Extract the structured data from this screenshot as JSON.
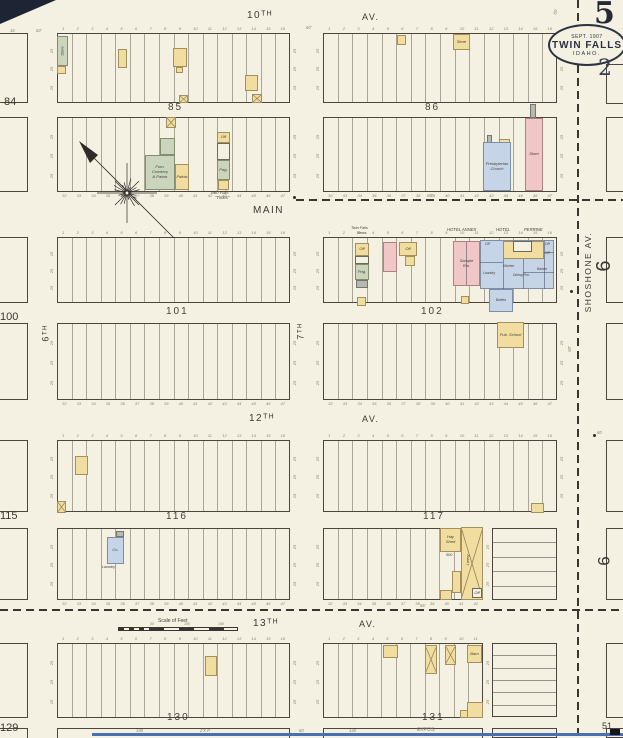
{
  "sheet": {
    "big_number": "5",
    "small_number": "2",
    "badge_date": "SEPT. 1907",
    "badge_city": "TWIN FALLS",
    "badge_state": "IDAHO."
  },
  "palette": {
    "paper": "#f4f0e2",
    "ink": "#4c463e",
    "cy": "#f1dd9f",
    "cp": "#f0c6c6",
    "cb": "#c5d4e7",
    "cg": "#cbd4bd",
    "cgr": "#b7b9b0",
    "scan": "#4a6fb3"
  },
  "lots": {
    "above_start": 1,
    "below_start": 32,
    "side_tick": "25"
  },
  "geometry": {
    "blocks": [
      [
        57,
        33,
        233,
        70,
        16,
        "a"
      ],
      [
        323,
        33,
        234,
        70,
        16,
        "a"
      ],
      [
        57,
        117,
        233,
        75,
        16,
        "b"
      ],
      [
        323,
        117,
        234,
        75,
        16,
        "b"
      ],
      [
        57,
        237,
        233,
        66,
        16,
        "a"
      ],
      [
        323,
        237,
        234,
        66,
        16,
        "a"
      ],
      [
        57,
        323,
        233,
        77,
        16,
        "b"
      ],
      [
        323,
        323,
        234,
        77,
        16,
        "b"
      ],
      [
        57,
        440,
        233,
        72,
        16,
        "a"
      ],
      [
        323,
        440,
        234,
        72,
        16,
        "a"
      ],
      [
        57,
        528,
        233,
        72,
        16,
        "b"
      ],
      [
        323,
        528,
        160,
        72,
        11,
        "b"
      ],
      [
        57,
        643,
        233,
        75,
        16,
        "a"
      ],
      [
        323,
        643,
        160,
        75,
        11,
        "a"
      ],
      [
        57,
        728,
        233,
        12,
        0,
        ""
      ],
      [
        323,
        728,
        160,
        12,
        0,
        ""
      ],
      [
        492,
        728,
        65,
        10,
        0,
        ""
      ]
    ],
    "partials": [
      [
        -14,
        33,
        42,
        70
      ],
      [
        -14,
        117,
        42,
        75
      ],
      [
        -14,
        237,
        42,
        66
      ],
      [
        -14,
        323,
        42,
        77
      ],
      [
        -14,
        440,
        42,
        72
      ],
      [
        -14,
        528,
        42,
        72
      ],
      [
        -14,
        643,
        42,
        75
      ],
      [
        -14,
        728,
        42,
        12
      ],
      [
        606,
        64,
        26,
        40
      ],
      [
        606,
        117,
        26,
        75
      ],
      [
        606,
        237,
        26,
        66
      ],
      [
        606,
        323,
        26,
        77
      ],
      [
        606,
        440,
        26,
        72
      ],
      [
        606,
        528,
        26,
        72
      ],
      [
        606,
        643,
        26,
        75
      ],
      [
        606,
        728,
        26,
        10
      ]
    ],
    "sections": [
      [
        492,
        528,
        65,
        72,
        5
      ],
      [
        492,
        643,
        65,
        74,
        6
      ]
    ],
    "dashes": [
      [
        "h",
        296,
        199,
        327
      ],
      [
        "h",
        0,
        609,
        623
      ],
      [
        "v",
        577,
        0,
        738
      ]
    ],
    "dots": [
      [
        294,
        197
      ],
      [
        571,
        291
      ],
      [
        594,
        435
      ]
    ],
    "ilines": [
      [
        503,
        259,
        503,
        289
      ],
      [
        523,
        259,
        523,
        289
      ],
      [
        544,
        241,
        544,
        289
      ],
      [
        480,
        262,
        503,
        262
      ],
      [
        523,
        272,
        554,
        272
      ],
      [
        544,
        252,
        554,
        252
      ],
      [
        466,
        242,
        466,
        285
      ]
    ]
  },
  "buildings": [
    {
      "x": 57,
      "y": 36,
      "w": 11,
      "h": 30,
      "c": "g",
      "l": "Store",
      "lr": -90
    },
    {
      "x": 57,
      "y": 66,
      "w": 9,
      "h": 8,
      "c": "y"
    },
    {
      "x": 118,
      "y": 49,
      "w": 9,
      "h": 19,
      "c": "y"
    },
    {
      "x": 173,
      "y": 48,
      "w": 14,
      "h": 19,
      "c": "y"
    },
    {
      "x": 176,
      "y": 67,
      "w": 7,
      "h": 6,
      "c": "y"
    },
    {
      "x": 245,
      "y": 75,
      "w": 13,
      "h": 16,
      "c": "y"
    },
    {
      "x": 179,
      "y": 95,
      "w": 9,
      "h": 8,
      "c": "y",
      "xm": 1
    },
    {
      "x": 252,
      "y": 94,
      "w": 10,
      "h": 9,
      "c": "y",
      "xm": 1
    },
    {
      "x": 166,
      "y": 117,
      "w": 10,
      "h": 11,
      "c": "y",
      "xm": 1
    },
    {
      "x": 160,
      "y": 138,
      "w": 15,
      "h": 17,
      "c": "g"
    },
    {
      "x": 145,
      "y": 155,
      "w": 30,
      "h": 35,
      "c": "g",
      "l": "Furn.\nCrockery\n& Paints"
    },
    {
      "x": 175,
      "y": 164,
      "w": 14,
      "h": 26,
      "c": "y",
      "l": "Paints"
    },
    {
      "x": 217,
      "y": 132,
      "w": 13,
      "h": 11,
      "c": "y",
      "l": "Off"
    },
    {
      "x": 217,
      "y": 143,
      "w": 13,
      "h": 17,
      "c": "w"
    },
    {
      "x": 217,
      "y": 160,
      "w": 13,
      "h": 20,
      "c": "g",
      "l": "Prtg."
    },
    {
      "x": 218,
      "y": 180,
      "w": 11,
      "h": 10,
      "c": "y"
    },
    {
      "x": 397,
      "y": 35,
      "w": 9,
      "h": 10,
      "c": "y"
    },
    {
      "x": 453,
      "y": 34,
      "w": 17,
      "h": 16,
      "c": "y",
      "l": "Store"
    },
    {
      "x": 487,
      "y": 135,
      "w": 5,
      "h": 8,
      "c": "gr"
    },
    {
      "x": 499,
      "y": 139,
      "w": 11,
      "h": 4,
      "c": "y"
    },
    {
      "x": 483,
      "y": 142,
      "w": 28,
      "h": 49,
      "c": "b",
      "l": "Presbyterian\nChurch"
    },
    {
      "x": 530,
      "y": 104,
      "w": 6,
      "h": 14,
      "c": "gr"
    },
    {
      "x": 525,
      "y": 118,
      "w": 18,
      "h": 73,
      "c": "p",
      "l": "Store"
    },
    {
      "x": 355,
      "y": 243,
      "w": 14,
      "h": 13,
      "c": "y",
      "l": "Off"
    },
    {
      "x": 355,
      "y": 256,
      "w": 14,
      "h": 8,
      "c": "w"
    },
    {
      "x": 355,
      "y": 264,
      "w": 14,
      "h": 16,
      "c": "g",
      "l": "Prtg."
    },
    {
      "x": 356,
      "y": 280,
      "w": 12,
      "h": 8,
      "c": "gr"
    },
    {
      "x": 357,
      "y": 297,
      "w": 9,
      "h": 9,
      "c": "y"
    },
    {
      "x": 383,
      "y": 242,
      "w": 14,
      "h": 30,
      "c": "p"
    },
    {
      "x": 399,
      "y": 242,
      "w": 18,
      "h": 14,
      "c": "y",
      "l": "Off"
    },
    {
      "x": 405,
      "y": 256,
      "w": 10,
      "h": 10,
      "c": "y"
    },
    {
      "x": 453,
      "y": 241,
      "w": 27,
      "h": 45,
      "c": "p",
      "l": "Sample\nRm."
    },
    {
      "x": 480,
      "y": 240,
      "w": 74,
      "h": 49,
      "c": "b"
    },
    {
      "x": 503,
      "y": 241,
      "w": 41,
      "h": 18,
      "c": "y"
    },
    {
      "x": 513,
      "y": 241,
      "w": 19,
      "h": 11,
      "c": "w"
    },
    {
      "x": 489,
      "y": 289,
      "w": 24,
      "h": 23,
      "c": "b",
      "l": "Baths"
    },
    {
      "x": 461,
      "y": 296,
      "w": 8,
      "h": 8,
      "c": "y"
    },
    {
      "x": 497,
      "y": 322,
      "w": 27,
      "h": 26,
      "c": "y",
      "l": "Pub. School"
    },
    {
      "x": 75,
      "y": 456,
      "w": 13,
      "h": 19,
      "c": "y"
    },
    {
      "x": 57,
      "y": 501,
      "w": 9,
      "h": 12,
      "c": "y",
      "xm": 1
    },
    {
      "x": 116,
      "y": 531,
      "w": 8,
      "h": 6,
      "c": "gr"
    },
    {
      "x": 107,
      "y": 537,
      "w": 17,
      "h": 27,
      "c": "b",
      "l": "Co."
    },
    {
      "x": 531,
      "y": 503,
      "w": 13,
      "h": 10,
      "c": "y"
    },
    {
      "x": 440,
      "y": 528,
      "w": 21,
      "h": 24,
      "c": "y",
      "l": "Hay\nShed"
    },
    {
      "x": 461,
      "y": 527,
      "w": 22,
      "h": 73,
      "c": "y",
      "xm": 1
    },
    {
      "x": 452,
      "y": 571,
      "w": 9,
      "h": 22,
      "c": "y"
    },
    {
      "x": 440,
      "y": 590,
      "w": 12,
      "h": 10,
      "c": "y"
    },
    {
      "x": 472,
      "y": 588,
      "w": 10,
      "h": 10,
      "c": "w",
      "l": "Off"
    },
    {
      "x": 205,
      "y": 656,
      "w": 12,
      "h": 20,
      "c": "y"
    },
    {
      "x": 383,
      "y": 645,
      "w": 15,
      "h": 13,
      "c": "y"
    },
    {
      "x": 425,
      "y": 645,
      "w": 12,
      "h": 29,
      "c": "y",
      "xm": 1
    },
    {
      "x": 445,
      "y": 645,
      "w": 11,
      "h": 20,
      "c": "y",
      "xm": 1
    },
    {
      "x": 467,
      "y": 645,
      "w": 15,
      "h": 18,
      "c": "y",
      "l": "Barn"
    },
    {
      "x": 467,
      "y": 702,
      "w": 16,
      "h": 16,
      "c": "y"
    },
    {
      "x": 460,
      "y": 710,
      "w": 8,
      "h": 8,
      "c": "y"
    }
  ],
  "labels": [
    {
      "t": "10ᵀᴴ",
      "x": 247,
      "y": 11,
      "s": 10,
      "cls": "street"
    },
    {
      "t": "AV.",
      "x": 362,
      "y": 13,
      "s": 9,
      "cls": "street"
    },
    {
      "t": "MAIN",
      "x": 253,
      "y": 206,
      "s": 10,
      "cls": "street"
    },
    {
      "t": "12ᵀᴴ",
      "x": 249,
      "y": 414,
      "s": 10,
      "cls": "street"
    },
    {
      "t": "AV.",
      "x": 362,
      "y": 415,
      "s": 9,
      "cls": "street"
    },
    {
      "t": "13ᵀᴴ",
      "x": 253,
      "y": 619,
      "s": 10,
      "cls": "street"
    },
    {
      "t": "AV.",
      "x": 359,
      "y": 620,
      "s": 9,
      "cls": "street"
    },
    {
      "t": "6ᵀᴴ",
      "x": 46,
      "y": 333,
      "s": 9,
      "cls": "street",
      "rot": -90
    },
    {
      "t": "7ᵀᴴ",
      "x": 301,
      "y": 331,
      "s": 9,
      "cls": "street",
      "rot": -90
    },
    {
      "t": "SHOSHONE  AV.",
      "x": 588,
      "y": 272,
      "s": 8.5,
      "cls": "street",
      "rot": -90
    },
    {
      "t": "85",
      "x": 168,
      "y": 103,
      "cls": "blocknum"
    },
    {
      "t": "86",
      "x": 425,
      "y": 103,
      "cls": "blocknum"
    },
    {
      "t": "101",
      "x": 166,
      "y": 307,
      "cls": "blocknum"
    },
    {
      "t": "102",
      "x": 421,
      "y": 307,
      "cls": "blocknum"
    },
    {
      "t": "116",
      "x": 166,
      "y": 512,
      "cls": "blocknum"
    },
    {
      "t": "117",
      "x": 423,
      "y": 512,
      "cls": "blocknum"
    },
    {
      "t": "130",
      "x": 167,
      "y": 713,
      "cls": "blocknum"
    },
    {
      "t": "131",
      "x": 422,
      "y": 713,
      "cls": "blocknum"
    },
    {
      "t": "84",
      "x": 4,
      "y": 97,
      "cls": "margin"
    },
    {
      "t": "100",
      "x": 0,
      "y": 312,
      "cls": "margin"
    },
    {
      "t": "115",
      "x": 0,
      "y": 511,
      "cls": "margin"
    },
    {
      "t": "129",
      "x": 0,
      "y": 723,
      "cls": "margin"
    },
    {
      "t": "51",
      "x": 602,
      "y": 722,
      "s": 9,
      "cls": "margin"
    },
    {
      "t": "6",
      "x": 604,
      "y": 266,
      "s": 20,
      "cls": "margin",
      "rot": -90
    },
    {
      "t": "6",
      "x": 604,
      "y": 561,
      "s": 17,
      "cls": "margin",
      "rot": -90
    },
    {
      "t": "50'",
      "x": 16,
      "y": 11,
      "cls": "dim",
      "rot": -70
    },
    {
      "t": "16",
      "x": 10,
      "y": 29,
      "cls": "dim"
    },
    {
      "t": "60'",
      "x": 36,
      "y": 29,
      "cls": "dim"
    },
    {
      "t": "60'",
      "x": 306,
      "y": 26,
      "cls": "dim"
    },
    {
      "t": "60'",
      "x": 556,
      "y": 12,
      "cls": "dim",
      "rot": -75
    },
    {
      "t": "60'",
      "x": 570,
      "y": 349,
      "cls": "dim",
      "rot": -90
    },
    {
      "t": "60",
      "x": 597,
      "y": 431,
      "cls": "dim"
    },
    {
      "t": "66'",
      "x": 427,
      "y": 194,
      "cls": "dim"
    },
    {
      "t": "66'",
      "x": 420,
      "y": 604,
      "cls": "dim"
    },
    {
      "t": "140",
      "x": 136,
      "y": 729,
      "cls": "dim"
    },
    {
      "t": "2'X P.",
      "x": 200,
      "y": 729,
      "cls": "dim"
    },
    {
      "t": "60",
      "x": 299,
      "y": 729,
      "cls": "dim"
    },
    {
      "t": "140",
      "x": 349,
      "y": 729,
      "cls": "dim"
    },
    {
      "t": "EXPOS.",
      "x": 417,
      "y": 728,
      "s": 5,
      "cls": "dim"
    },
    {
      "t": "Twin Falls",
      "x": 210,
      "y": 191,
      "cls": "cap"
    },
    {
      "t": "\"Times\"",
      "x": 215,
      "y": 196,
      "cls": "cap"
    },
    {
      "t": "Twin Falls",
      "x": 351,
      "y": 227,
      "s": 3.8,
      "cls": "cap"
    },
    {
      "t": "News",
      "x": 357,
      "y": 232,
      "s": 3.8,
      "cls": "cap"
    },
    {
      "t": "HOTEL ANNEX",
      "x": 447,
      "y": 228,
      "cls": "cap"
    },
    {
      "t": "HOTEL",
      "x": 496,
      "y": 228,
      "cls": "cap"
    },
    {
      "t": "PERRINE",
      "x": 524,
      "y": 228,
      "cls": "cap"
    },
    {
      "t": "Off",
      "x": 485,
      "y": 243,
      "s": 3.4,
      "cls": "cap"
    },
    {
      "t": "Off",
      "x": 545,
      "y": 243,
      "s": 3.4,
      "cls": "cap"
    },
    {
      "t": "Off",
      "x": 545,
      "y": 252,
      "s": 3.4,
      "cls": "cap"
    },
    {
      "t": "Kitchen",
      "x": 503,
      "y": 265,
      "s": 3.4,
      "cls": "cap"
    },
    {
      "t": "Dining Rm.",
      "x": 513,
      "y": 274,
      "s": 3.4,
      "cls": "cap"
    },
    {
      "t": "Barber",
      "x": 537,
      "y": 268,
      "s": 3.4,
      "cls": "cap"
    },
    {
      "t": "Laundry",
      "x": 483,
      "y": 272,
      "s": 3.4,
      "cls": "cap"
    },
    {
      "t": "500",
      "x": 446,
      "y": 554,
      "s": 3.8,
      "cls": "cap"
    },
    {
      "t": "Livery",
      "x": 468,
      "y": 560,
      "s": 4,
      "cls": "cap",
      "rot": -90
    },
    {
      "t": "Laundry",
      "x": 102,
      "y": 566,
      "s": 3.6,
      "cls": "cap"
    }
  ],
  "scale_bar": {
    "x": 112,
    "y": 616,
    "label": "Scale of Feet",
    "ticks": [
      "50",
      "100",
      "150"
    ]
  },
  "compass": {
    "cx": 127,
    "cy": 193,
    "arrow_from": [
      84,
      148
    ],
    "arrow_to": [
      174,
      238
    ]
  }
}
